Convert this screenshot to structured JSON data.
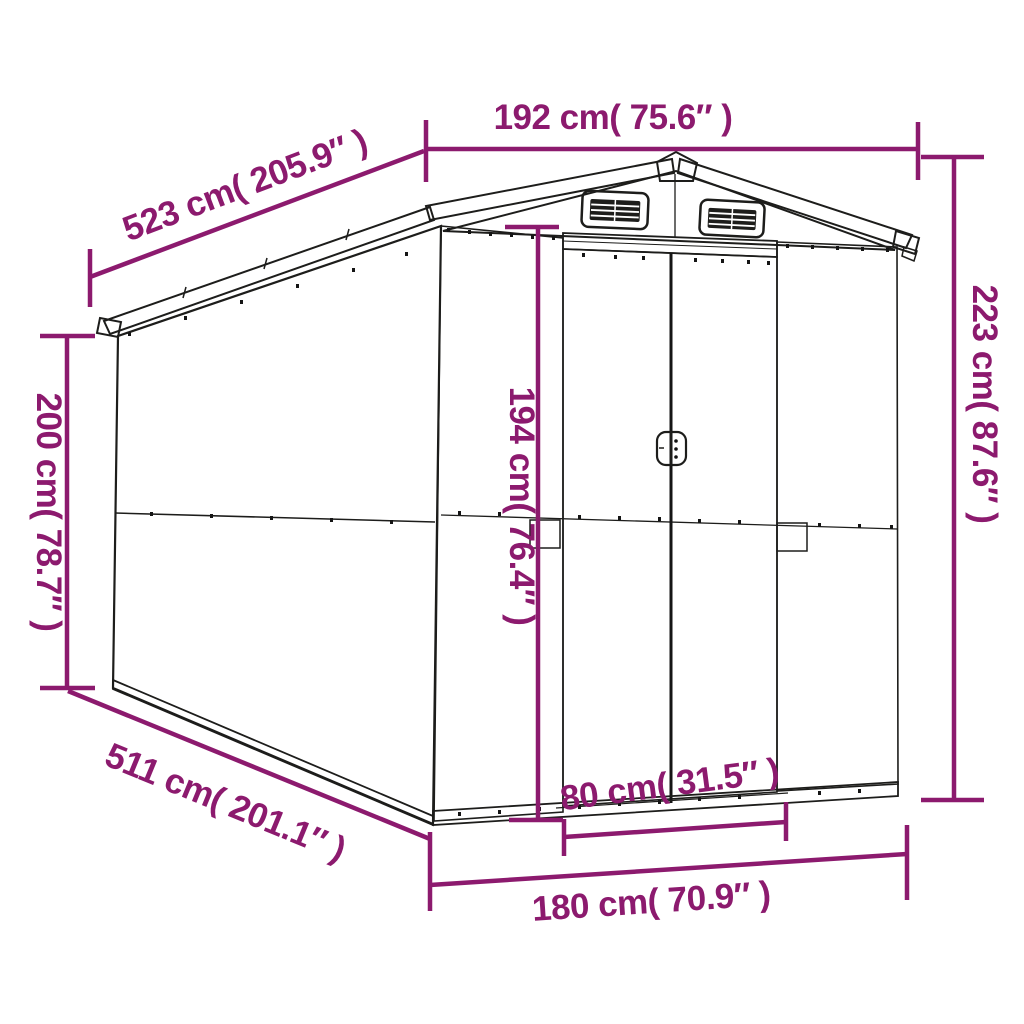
{
  "diagram": {
    "subject": "garden-shed-dimension-diagram",
    "colors": {
      "dimension_accent": "#8C1A6E",
      "line_art": "#1D1D1B",
      "background": "#FFFFFF"
    },
    "dimensions": {
      "roof_width": {
        "label": "192 cm( 75.6″ )",
        "cm": 192,
        "inches": 75.6
      },
      "roof_length": {
        "label": "523 cm( 205.9″ )",
        "cm": 523,
        "inches": 205.9
      },
      "wall_height": {
        "label": "200 cm( 78.7″ )",
        "cm": 200,
        "inches": 78.7
      },
      "door_height": {
        "label": "194 cm( 76.4″ )",
        "cm": 194,
        "inches": 76.4
      },
      "total_height": {
        "label": "223 cm( 87.6″ )",
        "cm": 223,
        "inches": 87.6
      },
      "door_width": {
        "label": "80 cm( 31.5″ )",
        "cm": 80,
        "inches": 31.5
      },
      "front_width": {
        "label": "180 cm( 70.9″ )",
        "cm": 180,
        "inches": 70.9
      },
      "base_length": {
        "label": "511 cm( 201.1″ )",
        "cm": 511,
        "inches": 201.1
      }
    }
  }
}
